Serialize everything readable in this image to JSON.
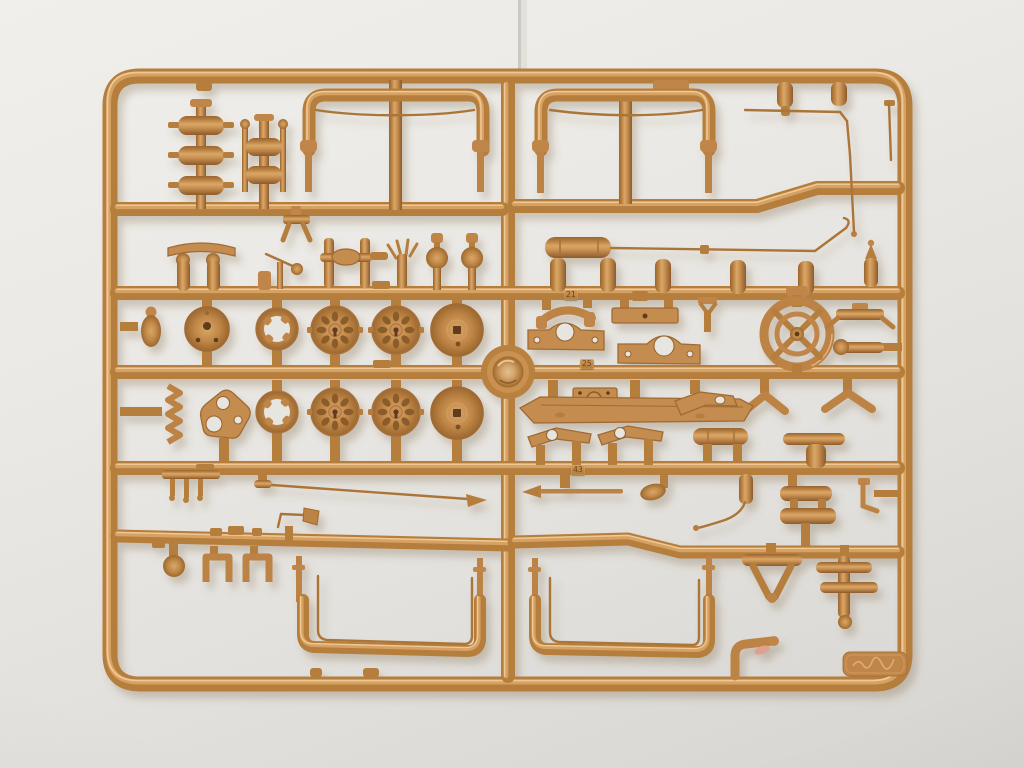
{
  "scene": {
    "type": "photograph",
    "description": "Tan injection-molded plastic model-kit sprue (parts tree) lying on light gray seamless paper, photographed from above",
    "background": "light warm-gray paper with faint vertical seam at top center and soft vignette"
  },
  "palette": {
    "plastic_base": "#bc8344",
    "plastic_highlight": "#dcaa6b",
    "plastic_bright": "#efc893",
    "plastic_shadow": "#96622e",
    "background_top": "#f0efeb",
    "background_bottom": "#d6d4d0",
    "flash_fleck": "#dfa090"
  },
  "tags": {
    "t21": "21",
    "t25": "25",
    "t43": "43"
  },
  "sprue": {
    "color_name": "tan / ochre plastic",
    "layout": "rounded-rectangle outer frame with one central vertical runner and five horizontal runners",
    "molded_number_tags": [
      "21",
      "25",
      "43"
    ],
    "maker_tab": "embossed illegible scribble on corner tab",
    "notable_parts": [
      "stacked exhaust silencers",
      "two wide roof bows with center legs",
      "nine road wheels (solid, castellated-ring, spoked, domed)",
      "four-spoke steering wheel",
      "long axle rod with cylinder end",
      "boat-shaped hull beam with pulley box",
      "lever arms with holes",
      "two large U-shaped fenders with inner wire",
      "U-clamps, ball knob, A-frame bracket, cross post, elbow pipe",
      "thin whip rod with arrow tip, trumpet horn, rake part"
    ],
    "wheel_count_visible": 9
  }
}
